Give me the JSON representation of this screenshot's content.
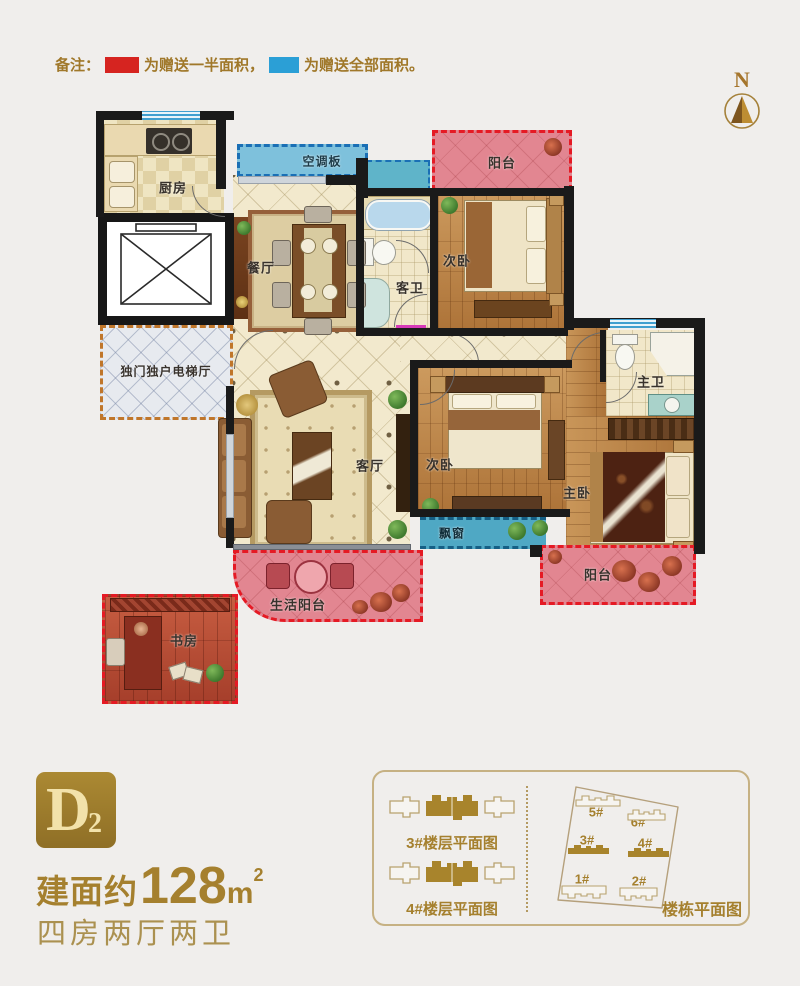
{
  "legend": {
    "prefix": "备注：",
    "red_label": "为赠送一半面积，",
    "blue_label": "为赠送全部面积。",
    "red_color": "#d62420",
    "blue_color": "#2b9fd6"
  },
  "compass": {
    "label": "N"
  },
  "plan": {
    "rooms": {
      "kitchen": "厨房",
      "ac_panel": "空调板",
      "balcony_top": "阳台",
      "bedroom_top": "次卧",
      "guest_bath": "客卫",
      "dining": "餐厅",
      "elevator_hall": "独门独户电梯厅",
      "living": "客厅",
      "bedroom_mid": "次卧",
      "master_bath": "主卫",
      "master_bedroom": "主卧",
      "bay_window": "飘窗",
      "life_balcony": "生活阳台",
      "balcony_bottom": "阳台",
      "study": "书房"
    }
  },
  "unit": {
    "code_letter": "D",
    "code_sub": "2",
    "area_prefix": "建面约",
    "area_value": "128",
    "area_unit": "m",
    "area_sup": "2",
    "rooms_desc": "四房两厅两卫"
  },
  "panel": {
    "floor3_label": "3#楼层平面图",
    "floor4_label": "4#楼层平面图",
    "site_label": "楼栋平面图",
    "buildings": [
      {
        "id": "1#"
      },
      {
        "id": "2#"
      },
      {
        "id": "3#"
      },
      {
        "id": "4#"
      },
      {
        "id": "5#"
      },
      {
        "id": "6#"
      }
    ]
  },
  "colors": {
    "accent_gold": "#a5802e",
    "wall": "#1a1a1a",
    "gift_half_red": "#e51a24",
    "gift_full_blue": "#2b9fd6",
    "balcony_pink": "#e28691",
    "window_teal": "#56afc9",
    "ac_panel_blue": "#7ec1dc",
    "tile_beige": "#f2e9cd",
    "wood_brown": "#c08a50"
  }
}
